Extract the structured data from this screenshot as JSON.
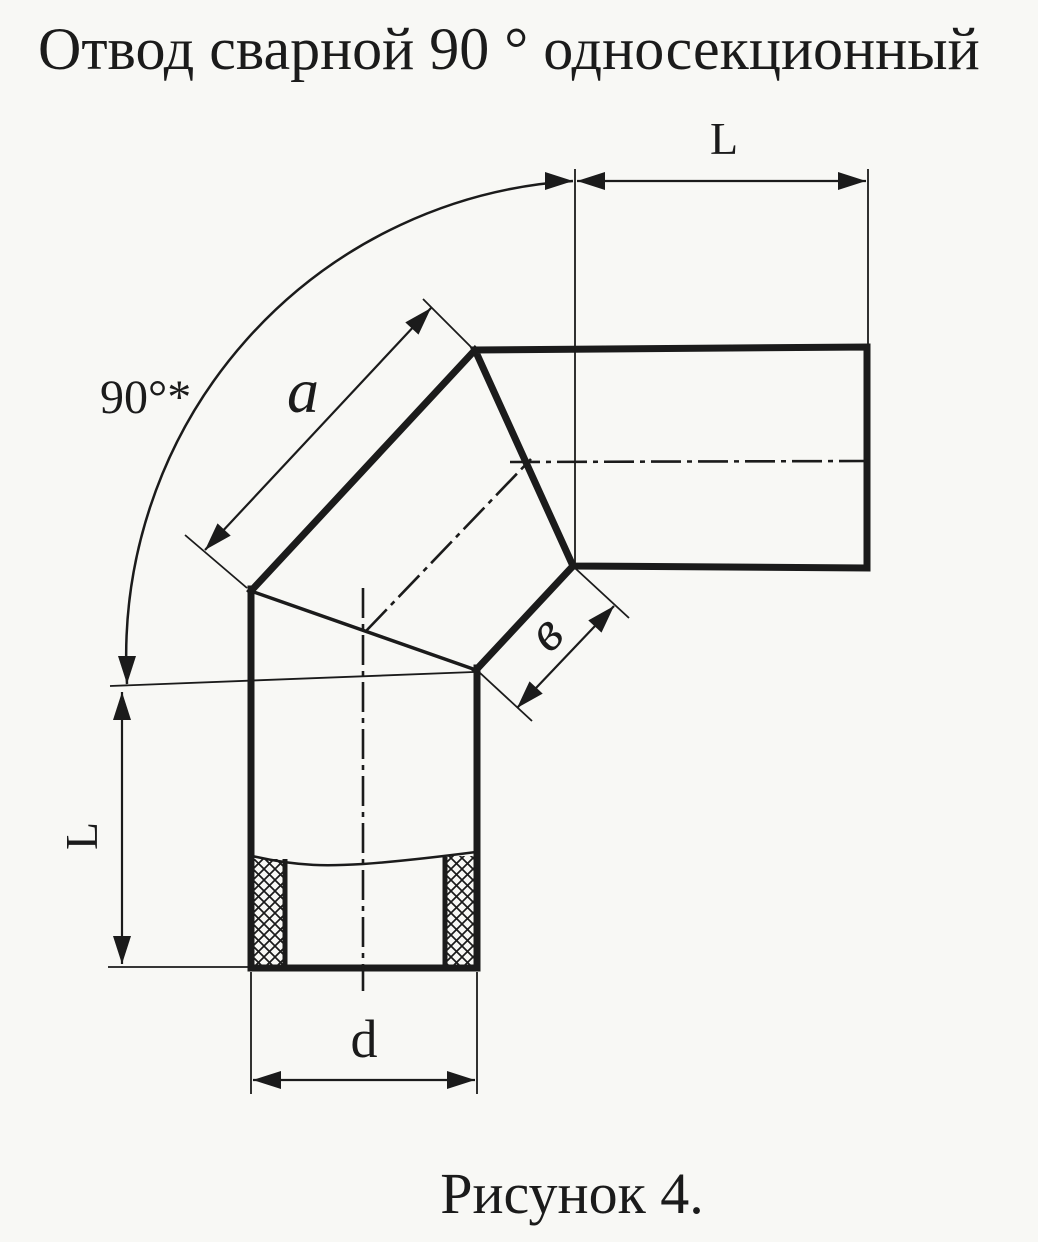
{
  "title": "Отвод сварной 90 ° односекционный",
  "figure_caption": "Рисунок 4.",
  "dimensions": {
    "horizontal_pipe_length": "L",
    "vertical_pipe_length": "L",
    "elbow_angle": "90°*",
    "section_edge": "a",
    "seam_width": "в",
    "pipe_diameter": "d"
  },
  "colors": {
    "ink": "#1b1b1b",
    "paper": "#f8f8f5"
  }
}
